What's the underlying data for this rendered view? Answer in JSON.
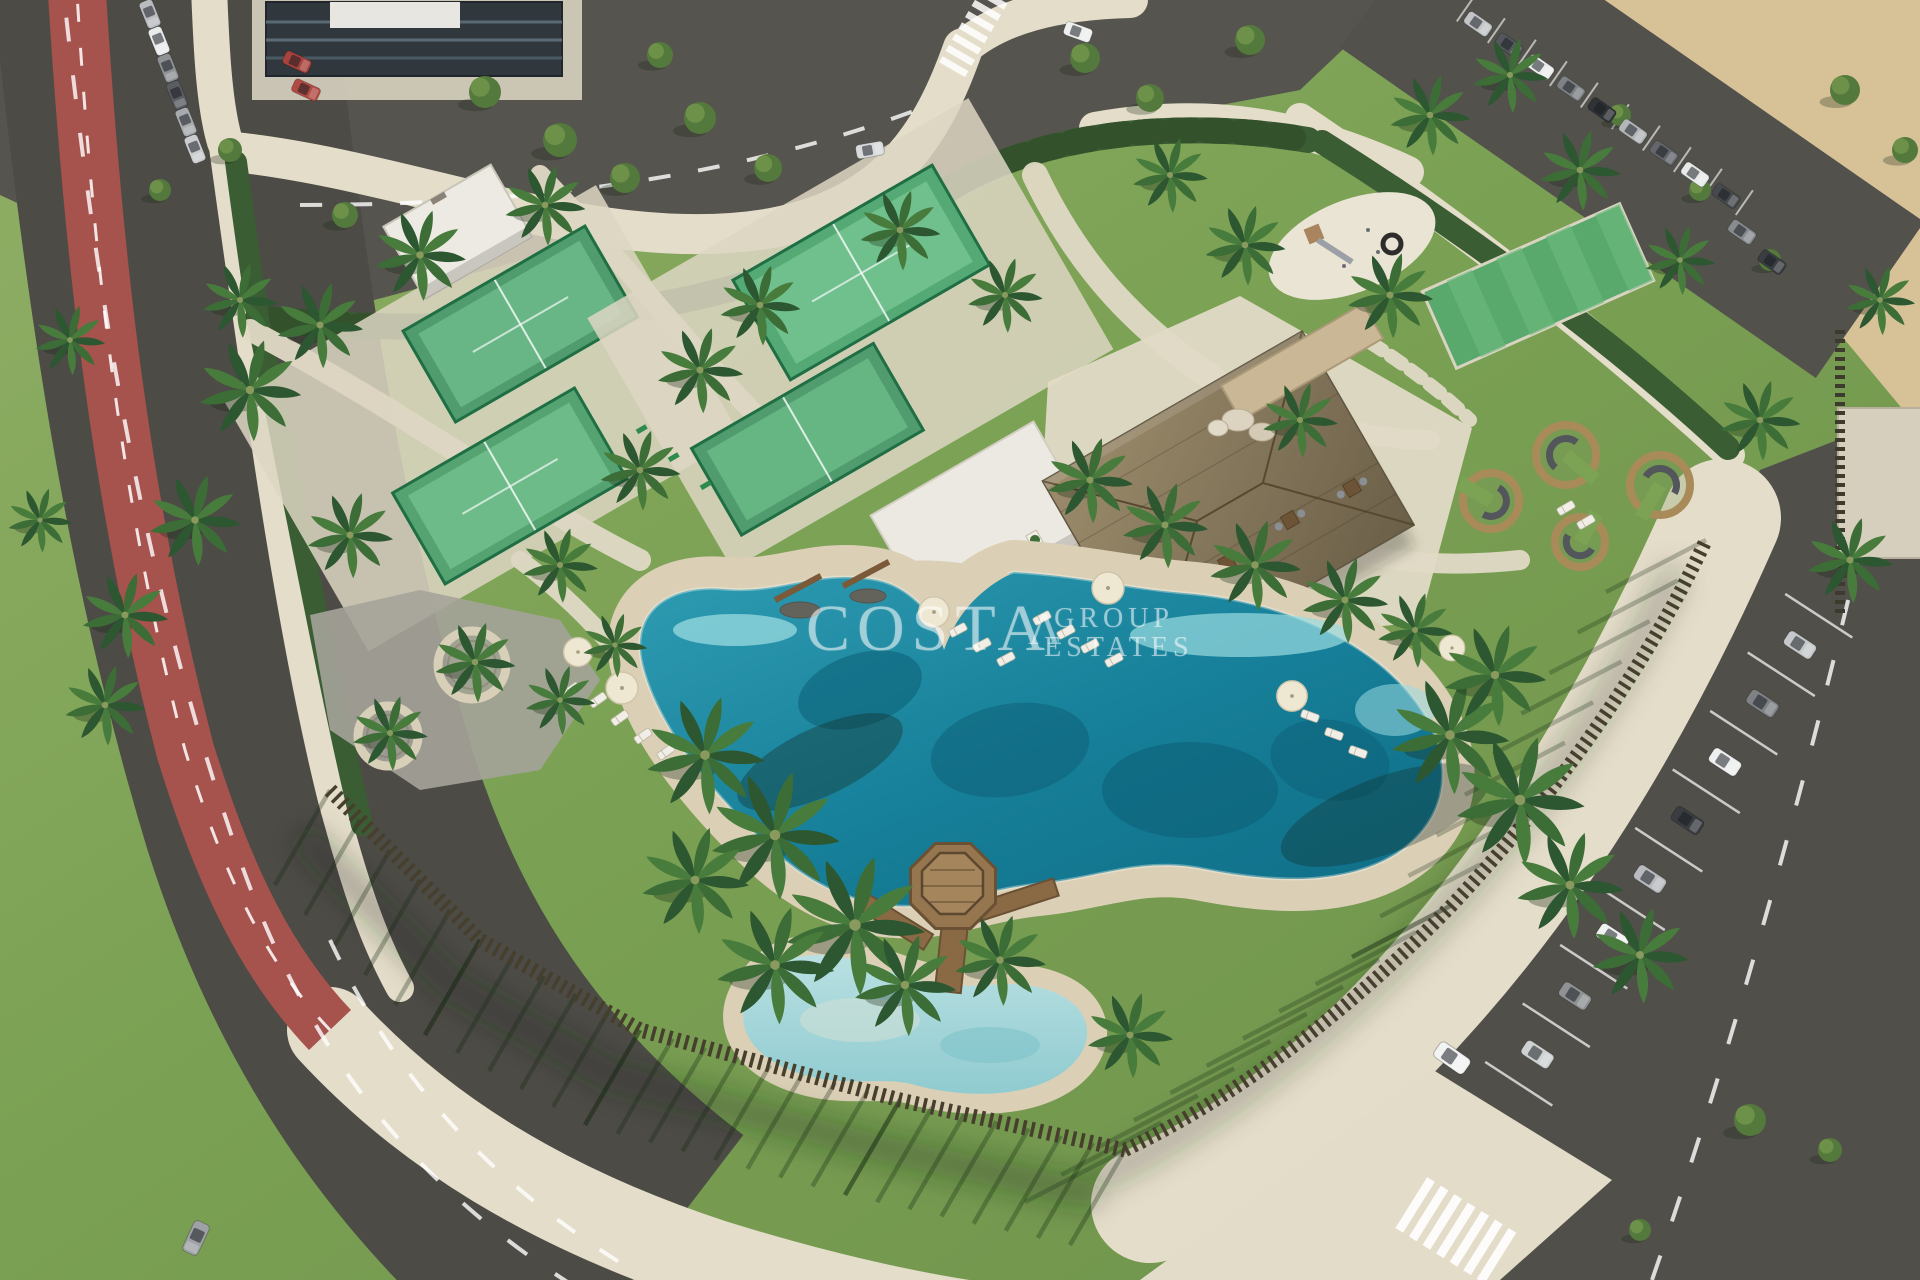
{
  "scene": {
    "type": "aerial-3d-render",
    "subject": "Aerial rendering of a resort amenity garden: lagoon-style swimming pool with sandy beach edge, kids pool with wooden gazebo deck, four fenced padel courts, thatched-roof clubhouse, playground, circular seating pods, palm-lined lawns, perimeter slat fence, surrounding roads with red bike lane and car parking",
    "time_of_day": "sunny midday, long shadows cast toward lower-left"
  },
  "watermark": {
    "primary": "COSTA",
    "secondary": "GROUP",
    "tertiary": "ESTATES",
    "mark": "Λ"
  },
  "colors": {
    "lawn": "#7da455",
    "lawn_light": "#9dbb6c",
    "water_deep": "#11788f",
    "water_light": "#66c3cf",
    "kids_pool": "#a7d8db",
    "sand": "#d7c298",
    "beach": "#dbd0b6",
    "paving": "#e3dcc8",
    "asphalt": "#53514c",
    "bike_lane": "#a6524d",
    "court_turf": "#4aa36b",
    "roof": "#8d7d60",
    "wood_deck": "#96764e",
    "fence": "#473f2d",
    "hedge": "#3b5d33",
    "watermark": "rgba(255,255,255,0.52)"
  }
}
